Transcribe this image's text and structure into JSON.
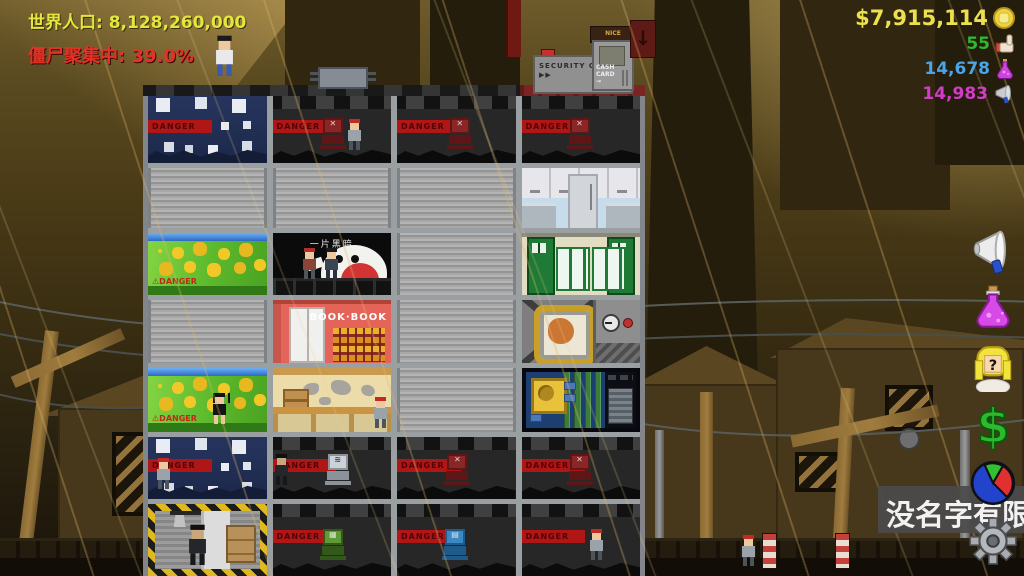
{
  "hud": {
    "world_population": "世界人口: 8,128,260,000",
    "zombie_gathering": "僵尸聚集中: 39.0%",
    "money": "$7,915,114",
    "likes": "55",
    "science": "14,678",
    "influence": "14,983"
  },
  "colors": {
    "population_text": "#e3e63e",
    "alert_text": "#e23226",
    "money_text": "#ece04e",
    "likes_text": "#2eb82e",
    "science_text": "#4aa4e8",
    "influence_text": "#d23cc8",
    "danger_tape": "#b01616",
    "farm_green": "#5cb82c",
    "bookstore_red": "#e4645a"
  },
  "roof": {
    "security_check": "SECURITY CHECK ▶▶",
    "shop_sign": "NICE TOFFEES",
    "atm_label": "CASH CARD →",
    "arrow_glyph": "↓"
  },
  "building": {
    "danger_label": "DANGER",
    "farm_warning": "⚠DANGER",
    "cafe_sign": "一片黑暗",
    "bookstore_sign": "BOOK·BOOK",
    "rooms": [
      [
        "armory",
        "guard-room-red-robot",
        "guard-room-red-robot",
        "guard-room-red-robot"
      ],
      [
        "vacant-floor",
        "vacant-floor",
        "vacant-floor",
        "kitchen-office"
      ],
      [
        "farm",
        "dark-cafe",
        "vacant-floor",
        "dormitory"
      ],
      [
        "vacant-floor",
        "bookstore",
        "vacant-floor",
        "incubator-lab"
      ],
      [
        "farm",
        "weapon-shop",
        "vacant-floor",
        "server-room"
      ],
      [
        "armory",
        "guard-room-silver-turret",
        "guard-room-red-robot",
        "guard-room-red-robot"
      ],
      [
        "lobby-entrance",
        "guard-room-green-turret",
        "guard-room-blue-turret",
        "corridor"
      ]
    ]
  },
  "sidebar": {
    "items": [
      {
        "name": "megaphone"
      },
      {
        "name": "potion"
      },
      {
        "name": "advisor-girl"
      },
      {
        "name": "finance"
      },
      {
        "name": "statistics-pie"
      },
      {
        "name": "settings-gear"
      }
    ]
  },
  "company_panel": {
    "label": "没名字有限"
  }
}
